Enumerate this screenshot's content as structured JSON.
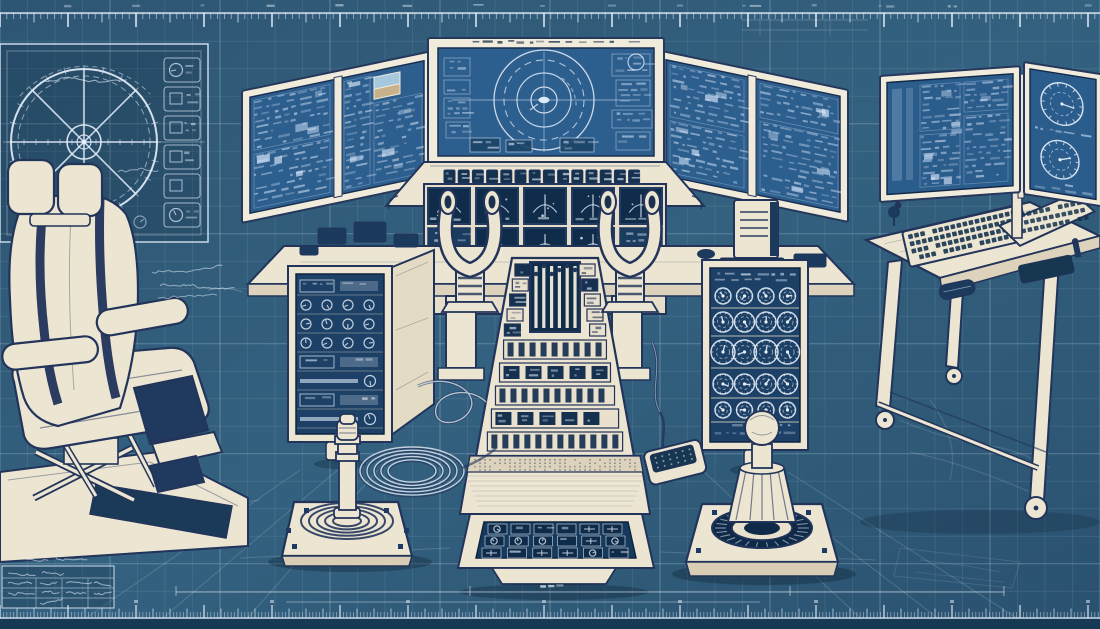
{
  "meta": {
    "title": "Flight simulator control station blueprint",
    "style": "blueprint technical illustration",
    "legible_text": "none (all annotations are illegible sketch scribbles)"
  },
  "palette": {
    "bg": "#31607f",
    "bg_edge": "#2a5270",
    "grid_minor": "#bcd6e6",
    "grid_major": "#d9ecf7",
    "ink": "#e9f2fb",
    "cream": "#ece5d2",
    "cream_dark": "#dcd1ba",
    "navy": "#22345a",
    "screen": "#2c5e8e",
    "screen_edge": "#16304f",
    "module": "#1d4066",
    "gauge_face": "#0f2c4b",
    "band_bottom": "#173a54",
    "sky": "#a6c8de",
    "sand": "#c9b28b"
  },
  "grid": {
    "cell": 27.5,
    "major_every": 4
  },
  "rulers": {
    "top": {
      "minor_spacing": 6.8,
      "medium_every": 5,
      "major_every": 10
    },
    "bottom": {
      "minor_spacing": 3.4,
      "tall_every": 5,
      "major_every": 20
    }
  },
  "scene": {
    "wheel_schematic": {
      "label": "control-wheel drawing",
      "spokes": 6,
      "icon_boxes": 6
    },
    "pilot_chair": {
      "label": "simulator seat with footrest and scissor base"
    },
    "monitors": {
      "left_wing_screens": 2,
      "center_screen_content": "radar plot",
      "right_wing_screens": 2,
      "desk_panel_left": "data tables",
      "desk_panel_right_gauges": 2
    },
    "instrument_panel": {
      "glareshield_icons": 14,
      "gauge_squares_row1": 5,
      "gauge_squares_row2": 3
    },
    "yokes": 2,
    "racks": {
      "left_module_rows": 8,
      "right_dial_rows": 5,
      "dials_per_row": 4
    },
    "pedestal": {
      "throttle_levers": 6,
      "slider_bands": 5,
      "tray_icon_cols": 6,
      "tray_icon_rows": 3
    },
    "joysticks": {
      "left": "segmented-shaft stick on ring boot",
      "right": "ball-grip fluted stick"
    },
    "desk_right": {
      "keyboards": 2,
      "mice": 1,
      "casters": 3
    },
    "cables": {
      "floor_coils": 2,
      "foot_pedal": 1
    }
  }
}
